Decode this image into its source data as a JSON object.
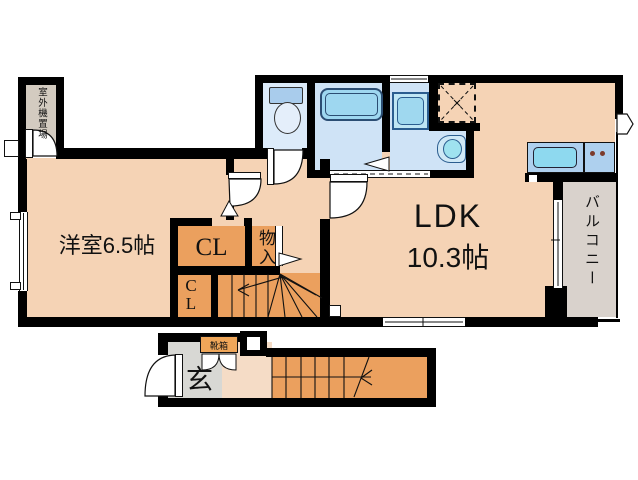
{
  "labels": {
    "western_room": "洋室6.5帖",
    "ldk_line1": "LDK",
    "ldk_line2": "10.3帖",
    "closet_upper": "CL",
    "closet_lower": "CL",
    "storage": "物入",
    "balcony": "バルコニー",
    "entrance": "玄",
    "shoe_box": "靴箱",
    "outdoor_unit": "室外機置場"
  },
  "colors": {
    "wall": "#000000",
    "room_floor": "#f5d3b5",
    "hall_floor": "#f5dcc6",
    "closet_and_stairs": "#eba05e",
    "wet_area_floor": "#cfe3f6",
    "toilet_room_floor": "#dcebfa",
    "water_fixture": "#9ed7f0",
    "kitchen_counter": "#aed0ee",
    "balcony_floor": "#d9d2cc",
    "entrance_floor": "#d8d8d4",
    "outdoor_unit_area": "#d3cbc0"
  }
}
